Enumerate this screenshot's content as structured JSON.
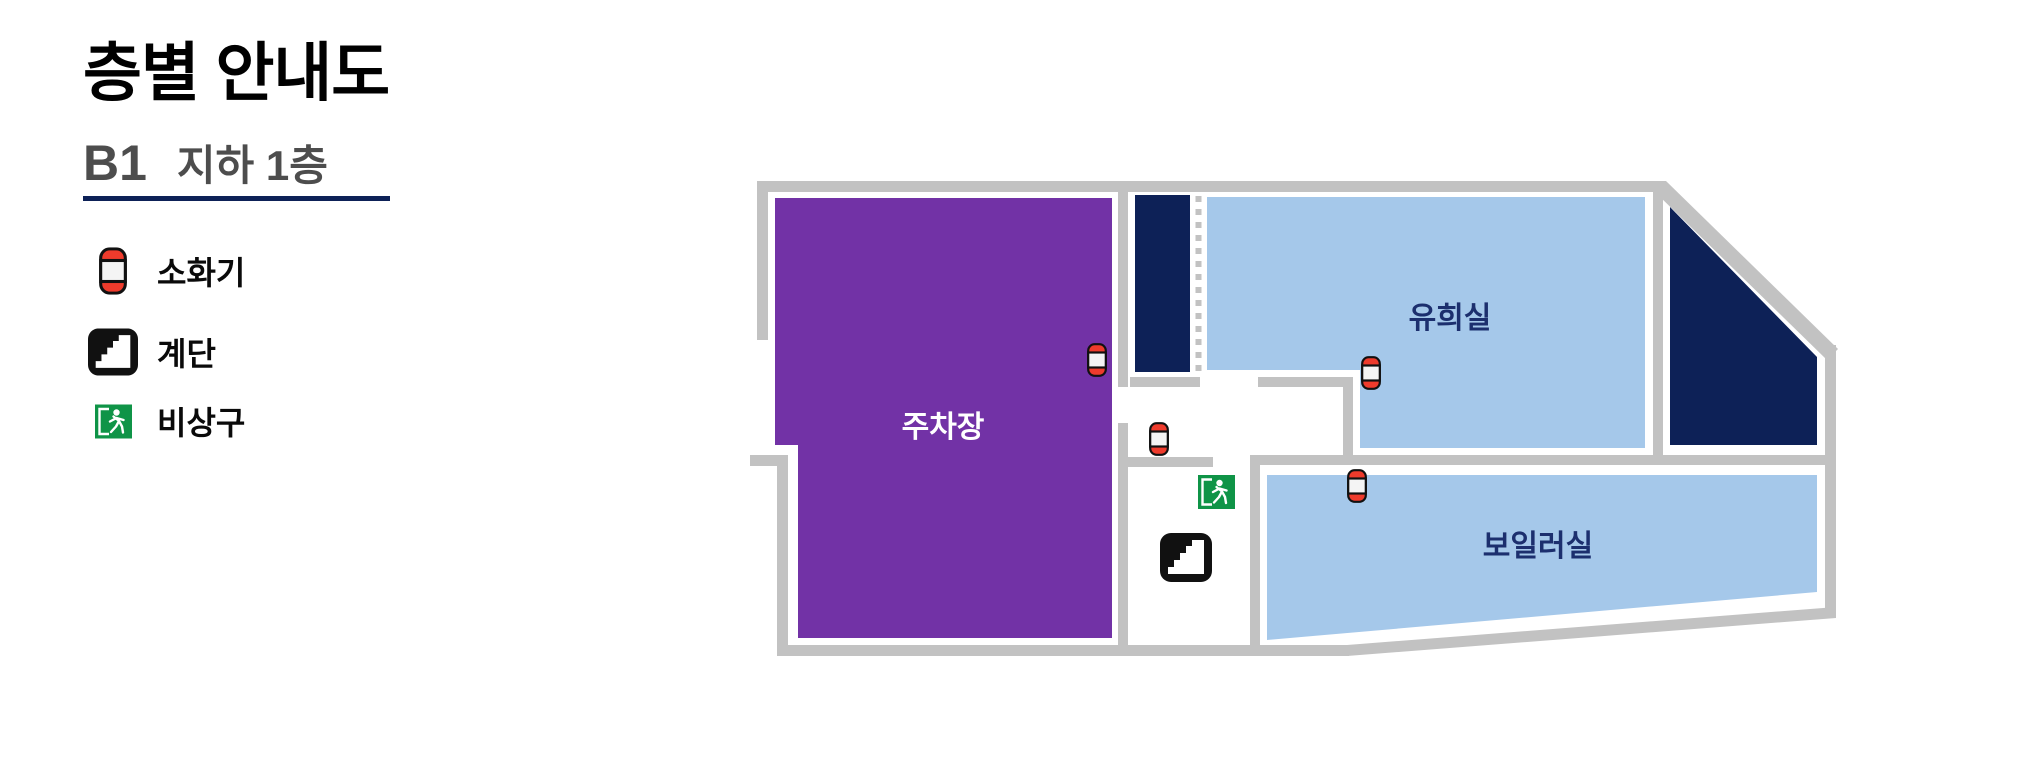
{
  "header": {
    "title": "층별 안내도",
    "floor_code": "B1",
    "floor_name": "지하 1층"
  },
  "legend": {
    "items": [
      {
        "icon": "fire-extinguisher-icon",
        "label": "소화기"
      },
      {
        "icon": "stairs-icon",
        "label": "계단"
      },
      {
        "icon": "emergency-exit-icon",
        "label": "비상구"
      }
    ]
  },
  "map": {
    "rooms": [
      {
        "id": "parking",
        "label": "주차장"
      },
      {
        "id": "playroom",
        "label": "유희실"
      },
      {
        "id": "boiler-room",
        "label": "보일러실"
      }
    ],
    "marker_counts": {
      "fire_extinguishers": 4,
      "stairs": 1,
      "emergency_exits": 1
    }
  },
  "colors": {
    "title_black": "#000000",
    "floor_text_gray": "#4d4d4d",
    "underline_navy": "#0d2157",
    "wall_gray": "#c2c2c2",
    "parking_purple": "#7232a6",
    "room_blue": "#a5c8ea",
    "stair_navy": "#0d2157",
    "label_navy": "#1c2f6e",
    "parking_label_white": "#ffffff",
    "extinguisher_red": "#ee3b2c",
    "extinguisher_body": "#f4f4f4",
    "exit_green": "#0f9447",
    "icon_black": "#111111"
  }
}
